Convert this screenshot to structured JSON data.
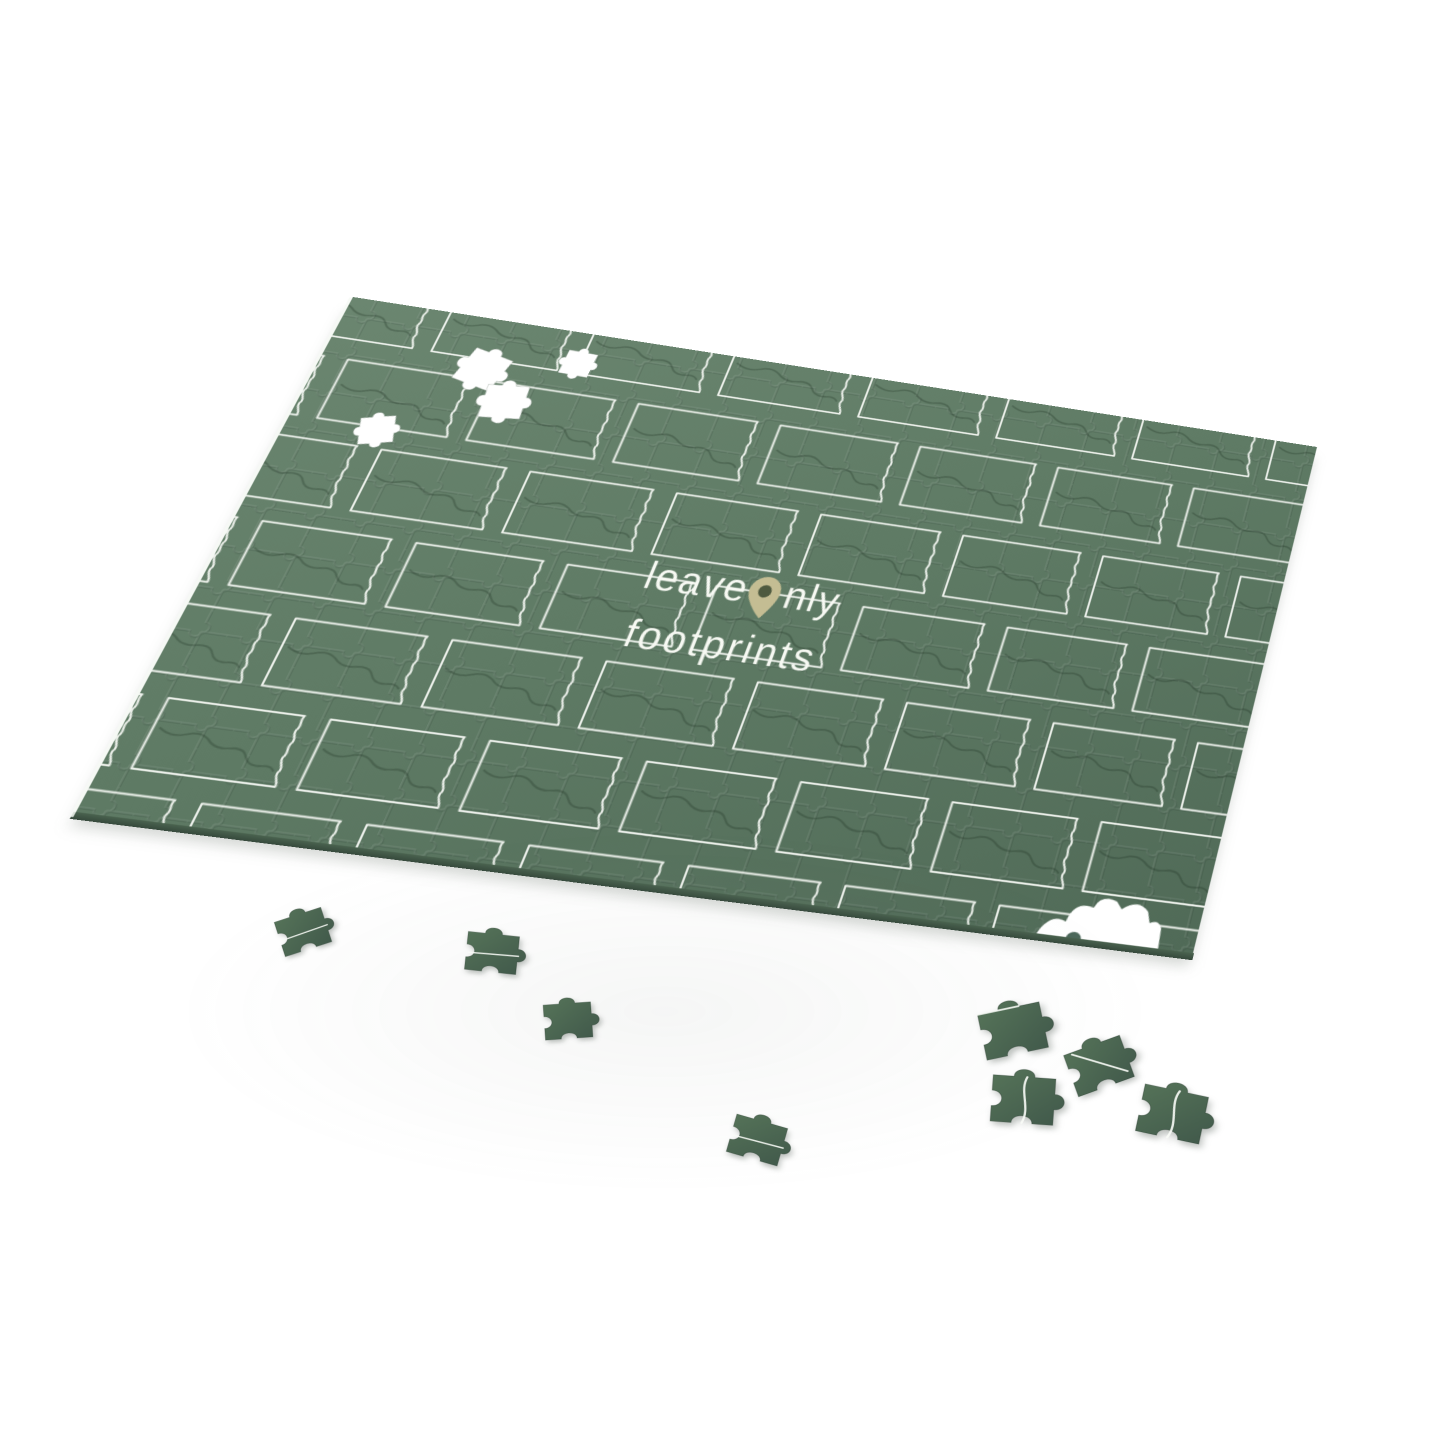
{
  "scene": {
    "background_color": "#ffffff",
    "shadow_color": "rgba(96,106,98,0.28)"
  },
  "logo": {
    "full_text": "leave only footprints",
    "line1_before_pin": "leave",
    "line1_after_pin": "nly",
    "line2": "footprints",
    "text_color": "#f7f9f3",
    "pin_color": "#c4bd93",
    "pin_hole_color": "#4e5a40"
  },
  "board": {
    "base_color": "#5e7a64",
    "highlight_color": "#6b8670",
    "deep_color": "#506a57",
    "tile_outline_color": "rgba(246,249,244,0.93)",
    "river_color": "rgba(24,42,30,0.28)",
    "cut_line_light": "rgba(255,255,255,0.09)",
    "cut_line_dark": "rgba(18,34,24,0.13)",
    "pattern_motif": "north-dakota-state-outline",
    "grid": {
      "cols": 7,
      "rows": 7,
      "pitch_x": 143,
      "pitch_y": 96.6,
      "origin_x": -46,
      "origin_y": -22,
      "brick_offset": 71.5
    },
    "missing_holes": [
      {
        "x": 152,
        "y": 62,
        "rot": 14,
        "scale": 0.62
      },
      {
        "x": 186,
        "y": 96,
        "rot": -6,
        "scale": 0.6
      },
      {
        "x": 238,
        "y": 38,
        "rot": 2,
        "scale": 0.44
      },
      {
        "x": 84,
        "y": 150,
        "rot": -16,
        "scale": 0.48
      }
    ]
  },
  "loose_pieces": {
    "fill_top": "#567459",
    "fill_bottom": "#40584a",
    "items": [
      {
        "x": 303,
        "y": 932,
        "rot": -18,
        "scale": 0.74,
        "line": "h"
      },
      {
        "x": 492,
        "y": 953,
        "rot": 6,
        "scale": 0.78,
        "line": "h"
      },
      {
        "x": 568,
        "y": 1021,
        "rot": -4,
        "scale": 0.72,
        "line": ""
      },
      {
        "x": 757,
        "y": 1140,
        "rot": 16,
        "scale": 0.8,
        "line": "h"
      },
      {
        "x": 1013,
        "y": 1031,
        "rot": -12,
        "scale": 0.95,
        "line": "edge"
      },
      {
        "x": 1023,
        "y": 1100,
        "rot": 4,
        "scale": 0.95,
        "line": "w"
      },
      {
        "x": 1099,
        "y": 1066,
        "rot": -20,
        "scale": 0.9,
        "line": "d"
      },
      {
        "x": 1172,
        "y": 1114,
        "rot": 12,
        "scale": 0.98,
        "line": "w"
      }
    ]
  }
}
